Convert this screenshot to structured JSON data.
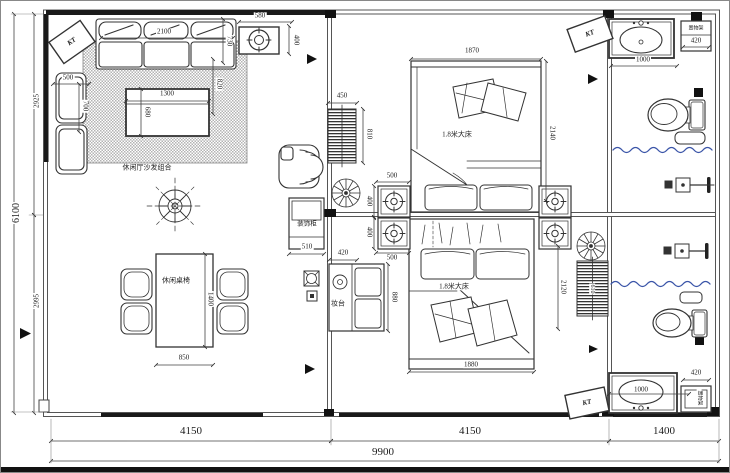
{
  "meta": {
    "drawing_type": "floor-plan"
  },
  "overall": {
    "total_width": "9900",
    "total_height": "6100",
    "bottom_segments": [
      "4150",
      "4150",
      "1400"
    ],
    "left_segments": [
      "2925",
      "2995"
    ]
  },
  "colors": {
    "line": "#333333",
    "wall_fill": "#1a1a1a",
    "curtain_blue": "#3b55a8"
  },
  "rooms": {
    "living_sofa": "休闲厅沙发组合",
    "dining": "休闲桌椅",
    "bedroom_bed": "1.8米大床",
    "cabinet": "装饰柜",
    "dresser": "妆台",
    "shelf": "置物架",
    "air_conditioner": "KT"
  },
  "annotations": [
    {
      "name": "dim-580",
      "text": "580",
      "x": 259,
      "y": 15,
      "rot": 0
    },
    {
      "name": "dim-400-ac",
      "text": "400",
      "x": 295,
      "y": 39,
      "rot": 90
    },
    {
      "name": "dim-2100",
      "text": "2100",
      "x": 163,
      "y": 31,
      "rot": 0
    },
    {
      "name": "dim-730",
      "text": "730",
      "x": 228,
      "y": 40,
      "rot": 90
    },
    {
      "name": "dim-820",
      "text": "820",
      "x": 218,
      "y": 83,
      "rot": 90
    },
    {
      "name": "dim-500-armchair",
      "text": "500",
      "x": 67,
      "y": 77,
      "rot": 0
    },
    {
      "name": "dim-700-armchair",
      "text": "700",
      "x": 84,
      "y": 105,
      "rot": 90
    },
    {
      "name": "dim-1300",
      "text": "1300",
      "x": 166,
      "y": 93,
      "rot": 0
    },
    {
      "name": "dim-680",
      "text": "680",
      "x": 146,
      "y": 111,
      "rot": 90
    },
    {
      "name": "label-sofa-group",
      "text": "休闲厅沙发组合",
      "x": 146,
      "y": 167,
      "rot": 0
    },
    {
      "name": "dim-2925",
      "text": "2925",
      "x": 36,
      "y": 100,
      "rot": -90
    },
    {
      "name": "dim-6100",
      "text": "6100",
      "x": 16,
      "y": 212,
      "rot": -90,
      "size": 10
    },
    {
      "name": "dim-2995",
      "text": "2995",
      "x": 36,
      "y": 300,
      "rot": -90
    },
    {
      "name": "label-dining",
      "text": "休闲桌椅",
      "x": 175,
      "y": 280,
      "rot": 0
    },
    {
      "name": "dim-1400-table",
      "text": "1400",
      "x": 209,
      "y": 298,
      "rot": 90
    },
    {
      "name": "dim-850",
      "text": "850",
      "x": 183,
      "y": 357,
      "rot": 0
    },
    {
      "name": "dim-450",
      "text": "450",
      "x": 341,
      "y": 95,
      "rot": 0
    },
    {
      "name": "dim-810",
      "text": "810",
      "x": 368,
      "y": 133,
      "rot": 90
    },
    {
      "name": "dim-500-ns-top",
      "text": "500",
      "x": 391,
      "y": 175,
      "rot": 0
    },
    {
      "name": "dim-400-ns1",
      "text": "400",
      "x": 368,
      "y": 200,
      "rot": 90
    },
    {
      "name": "dim-400-ns2",
      "text": "400",
      "x": 368,
      "y": 231,
      "rot": 90
    },
    {
      "name": "dim-500-ns-bottom",
      "text": "500",
      "x": 391,
      "y": 257,
      "rot": 0
    },
    {
      "name": "dim-1870",
      "text": "1870",
      "x": 471,
      "y": 50,
      "rot": 0
    },
    {
      "name": "dim-2140",
      "text": "2140",
      "x": 551,
      "y": 132,
      "rot": 90
    },
    {
      "name": "label-bed1",
      "text": "1.8米大床",
      "x": 456,
      "y": 134,
      "rot": 0
    },
    {
      "name": "label-bed2",
      "text": "1.8米大床",
      "x": 453,
      "y": 286,
      "rot": 0
    },
    {
      "name": "dim-1880",
      "text": "1880",
      "x": 470,
      "y": 364,
      "rot": 0
    },
    {
      "name": "dim-2120",
      "text": "2120",
      "x": 562,
      "y": 286,
      "rot": 90
    },
    {
      "name": "dim-610",
      "text": "610",
      "x": 591,
      "y": 288,
      "rot": 90,
      "size": 6
    },
    {
      "name": "dim-880",
      "text": "880",
      "x": 393,
      "y": 296,
      "rot": 90
    },
    {
      "name": "dim-420-dresser",
      "text": "420",
      "x": 342,
      "y": 252,
      "rot": 0
    },
    {
      "name": "label-dresser",
      "text": "妆台",
      "x": 337,
      "y": 303,
      "rot": 0
    },
    {
      "name": "label-cabinet",
      "text": "装饰柜",
      "x": 306,
      "y": 224,
      "rot": 0,
      "size": 6.5
    },
    {
      "name": "dim-510",
      "text": "510",
      "x": 306,
      "y": 246,
      "rot": 0
    },
    {
      "name": "dim-1000-sink-top",
      "text": "1000",
      "x": 642,
      "y": 59,
      "rot": 0
    },
    {
      "name": "label-shelf-top",
      "text": "置物架",
      "x": 695,
      "y": 28,
      "rot": 0,
      "size": 5
    },
    {
      "name": "dim-420-shelf-top",
      "text": "420",
      "x": 695,
      "y": 40,
      "rot": 0
    },
    {
      "name": "dim-1000-sink-bottom",
      "text": "1000",
      "x": 640,
      "y": 389,
      "rot": 0
    },
    {
      "name": "dim-420-shelf-bottom",
      "text": "420",
      "x": 695,
      "y": 372,
      "rot": 0
    },
    {
      "name": "label-shelf-bottom",
      "text": "置物架",
      "x": 698,
      "y": 397,
      "rot": 90,
      "size": 5
    },
    {
      "name": "label-ac-1",
      "text": "KT",
      "x": 71,
      "y": 41,
      "rot": -35
    },
    {
      "name": "label-ac-2",
      "text": "KT",
      "x": 589,
      "y": 33,
      "rot": -20
    },
    {
      "name": "label-ac-3",
      "text": "KT",
      "x": 586,
      "y": 402,
      "rot": -12
    },
    {
      "name": "dim-4150-left",
      "text": "4150",
      "x": 190,
      "y": 431,
      "rot": 0,
      "size": 11
    },
    {
      "name": "dim-4150-mid",
      "text": "4150",
      "x": 469,
      "y": 431,
      "rot": 0,
      "size": 11
    },
    {
      "name": "dim-1400-right",
      "text": "1400",
      "x": 663,
      "y": 431,
      "rot": 0,
      "size": 11
    },
    {
      "name": "dim-9900",
      "text": "9900",
      "x": 382,
      "y": 452,
      "rot": 0,
      "size": 11
    }
  ]
}
